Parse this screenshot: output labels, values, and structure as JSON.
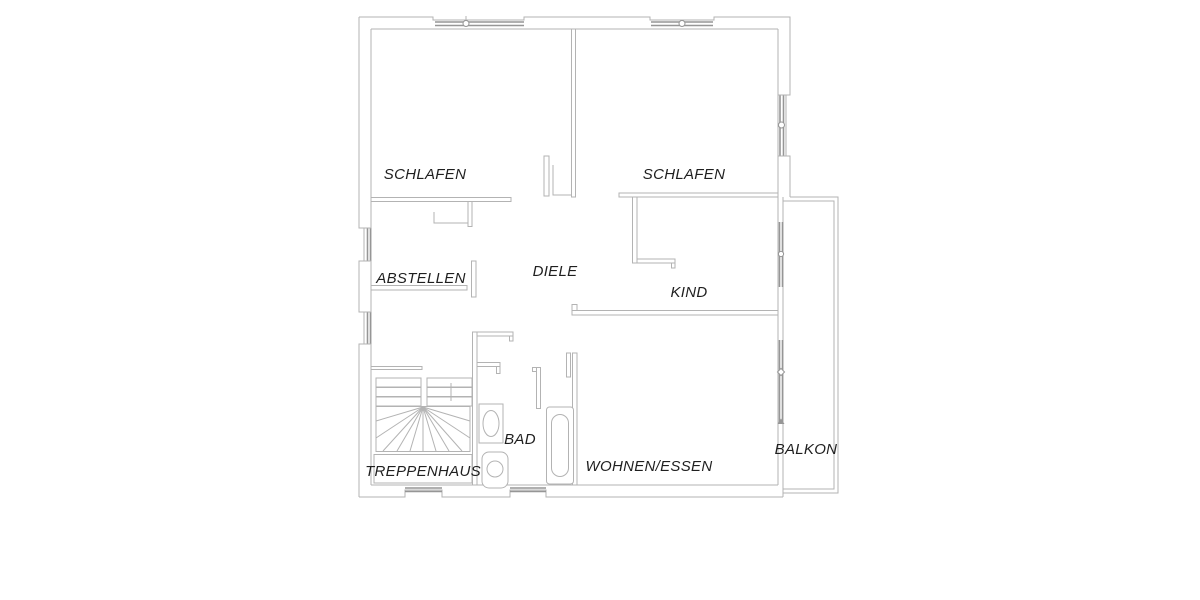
{
  "plan": {
    "type": "floor-plan",
    "rooms": [
      {
        "id": "schlafen-left",
        "label": "SCHLAFEN"
      },
      {
        "id": "schlafen-right",
        "label": "SCHLAFEN"
      },
      {
        "id": "abstellen",
        "label": "ABSTELLEN"
      },
      {
        "id": "diele",
        "label": "DIELE"
      },
      {
        "id": "kind",
        "label": "KIND"
      },
      {
        "id": "bad",
        "label": "BAD"
      },
      {
        "id": "treppenhaus",
        "label": "TREPPENHAUS"
      },
      {
        "id": "wohnen-essen",
        "label": "WOHNEN/ESSEN"
      },
      {
        "id": "balkon",
        "label": "BALKON"
      }
    ],
    "fixtures": [
      "staircase",
      "washbasin",
      "toilet",
      "bathtub"
    ],
    "colors": {
      "background": "#ffffff",
      "wall": "#b3b3b3",
      "window": "#969696",
      "label": "#1f1f1f"
    }
  }
}
